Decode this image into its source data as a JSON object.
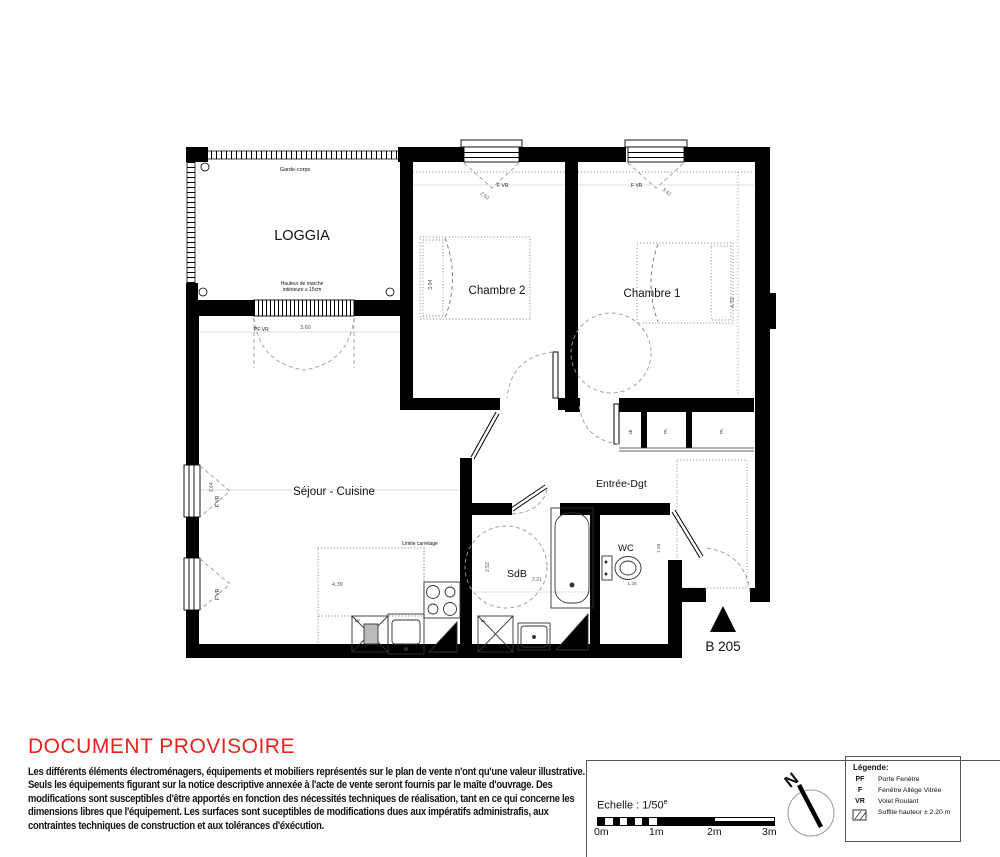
{
  "plan": {
    "unit_label": "B 205",
    "loggia": {
      "name": "LOGGIA",
      "railing": "Garde-corps",
      "step_note_1": "Hauteur de marche",
      "step_note_2": "intérieure ≤ 15cm",
      "door_type": "PF VR",
      "door_width": "3.60"
    },
    "chambre2": {
      "name": "Chambre 2",
      "window_type": "F VR",
      "window_width": "2.52",
      "room_depth": "3.94"
    },
    "chambre1": {
      "name": "Chambre 1",
      "window_type": "F VR",
      "window_width": "3.42",
      "room_depth": "4.72"
    },
    "sejour": {
      "name": "Séjour - Cuisine",
      "window_type": "F VR",
      "window_height": "3.64",
      "kitchen_width": "4.39",
      "tile_limit": "Limite carrelage",
      "dishwasher": "LV"
    },
    "entree": {
      "name": "Entrée-Dgt"
    },
    "sdb": {
      "name": "SdB",
      "width": "2.21",
      "depth": "2.52",
      "washer": "LL"
    },
    "wc": {
      "name": "WC",
      "width": "1.38",
      "depth": "1.39"
    },
    "closets": {
      "water_heater": "ch",
      "placard_1": "PL",
      "placard_2": "PL"
    }
  },
  "notice": {
    "title": "DOCUMENT PROVISOIRE",
    "lines": [
      "Les différents éléments électroménagers, équipements et mobiliers représentés sur le plan de vente n'ont qu'une valeur illustrative.",
      "Seuls les équipements figurant sur la notice descriptive annexée à l'acte de vente seront fournis par le maîte d'ouvrage. Des",
      "modifications sont susceptibles d'être apportés en fonction des nécessités techniques de réalisation, tant en ce qui concerne les",
      "dimensions libres que l'équipement. Les surfaces sont suceptibles de modifications dues aux impératifs administrafis, aux",
      "contraintes techniques de construction et aux tolérances d'éxécution."
    ]
  },
  "titleblock": {
    "scale_label": "Echelle : 1/50",
    "scale_exp": "e",
    "ticks": [
      "0m",
      "1m",
      "2m",
      "3m"
    ],
    "north": "N",
    "legend_title": "Légende:",
    "legend": [
      {
        "abbr": "PF",
        "label": "Porte Fenêtre"
      },
      {
        "abbr": "F",
        "label": "Fenêtre Allège Vitrée"
      },
      {
        "abbr": "VR",
        "label": "Volet Roulant"
      },
      {
        "label": "Soffite hauteur ± 2.20 m"
      }
    ]
  }
}
